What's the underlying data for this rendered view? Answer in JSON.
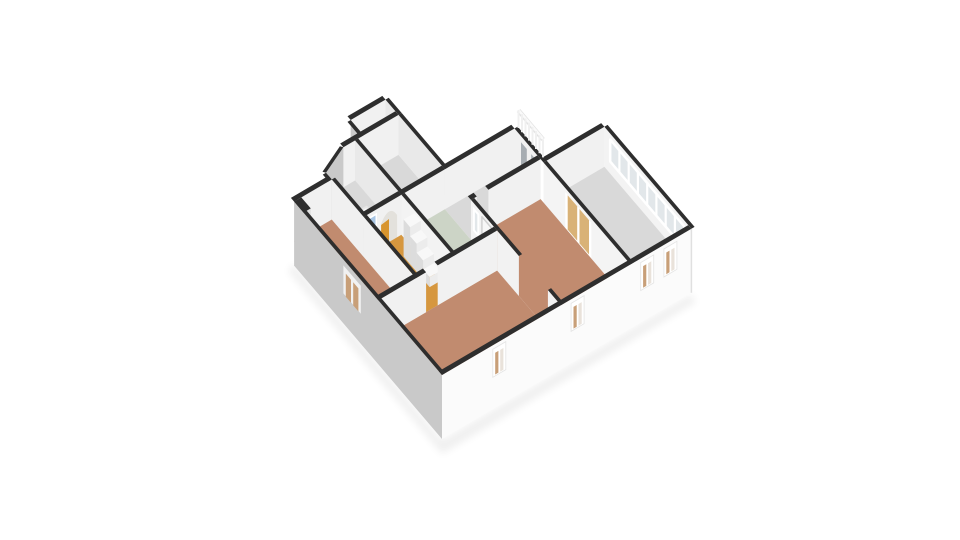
{
  "scene": {
    "type": "3d-floor-plan-isometric-view",
    "background": "#ffffff",
    "visible_text": ""
  },
  "palette": {
    "wall_cap": "#2e2e2e",
    "wall_int_light": "#f1f1f1",
    "wall_int_mid": "#e9e9e9",
    "wall_ext_shade": "#c9c9c9",
    "wall_ext_light": "#fbfbfb",
    "floor_wood": "#c18b6f",
    "floor_orange": "#d6973f",
    "floor_green": "#ccd4c6",
    "floor_gray": "#d9d9d9",
    "door_tan": "#d9b277",
    "glass_blue": "#a9c6e4",
    "glass_pale": "#e2e7ea",
    "glass_dark": "#a7adb2",
    "window_tan": "#c89f78",
    "accent_orange": "#d8952f"
  },
  "structure": {
    "rooms": [
      {
        "id": "living-room",
        "floor": "floor_wood",
        "features": [
          "window-on-se-facade",
          "door-opening-to-hall",
          "wide-opening-to-right-bedroom"
        ]
      },
      {
        "id": "bedroom-left",
        "floor": "floor_wood",
        "features": [
          "window-on-sw-facade",
          "chimney-nub-at-corner"
        ]
      },
      {
        "id": "bedroom-right",
        "floor": "floor_wood",
        "features": [
          "window-on-se-facade",
          "tan-double-doors",
          "door-to-landing"
        ]
      },
      {
        "id": "bathroom",
        "floor": "floor_green",
        "features": [
          "white-door",
          "small-interior-window"
        ]
      },
      {
        "id": "hallway",
        "floor": "floor_orange",
        "features": [
          "staircase",
          "arched-opening",
          "blue-glazed-panel",
          "orange-door-leaf"
        ]
      },
      {
        "id": "sunroom",
        "floor": "floor_gray",
        "features": [
          "glazed-window-band",
          "two-windows-on-se-facade",
          "tan-double-doors"
        ]
      },
      {
        "id": "landing",
        "floor": "floor_gray",
        "features": [
          "balustrade",
          "two-dark-interior-windows"
        ]
      },
      {
        "id": "attic-room",
        "floor": "floor_gray",
        "features": [
          "skylight-panel",
          "angled-bay-wall"
        ]
      },
      {
        "id": "back-room",
        "floor": "floor_gray",
        "features": []
      }
    ],
    "counts": {
      "windows_se_facade": 4,
      "windows_sw_facade": 1,
      "stair_steps": 4,
      "balustrade_slats": 8,
      "sunroom_band_panes": 8
    }
  }
}
